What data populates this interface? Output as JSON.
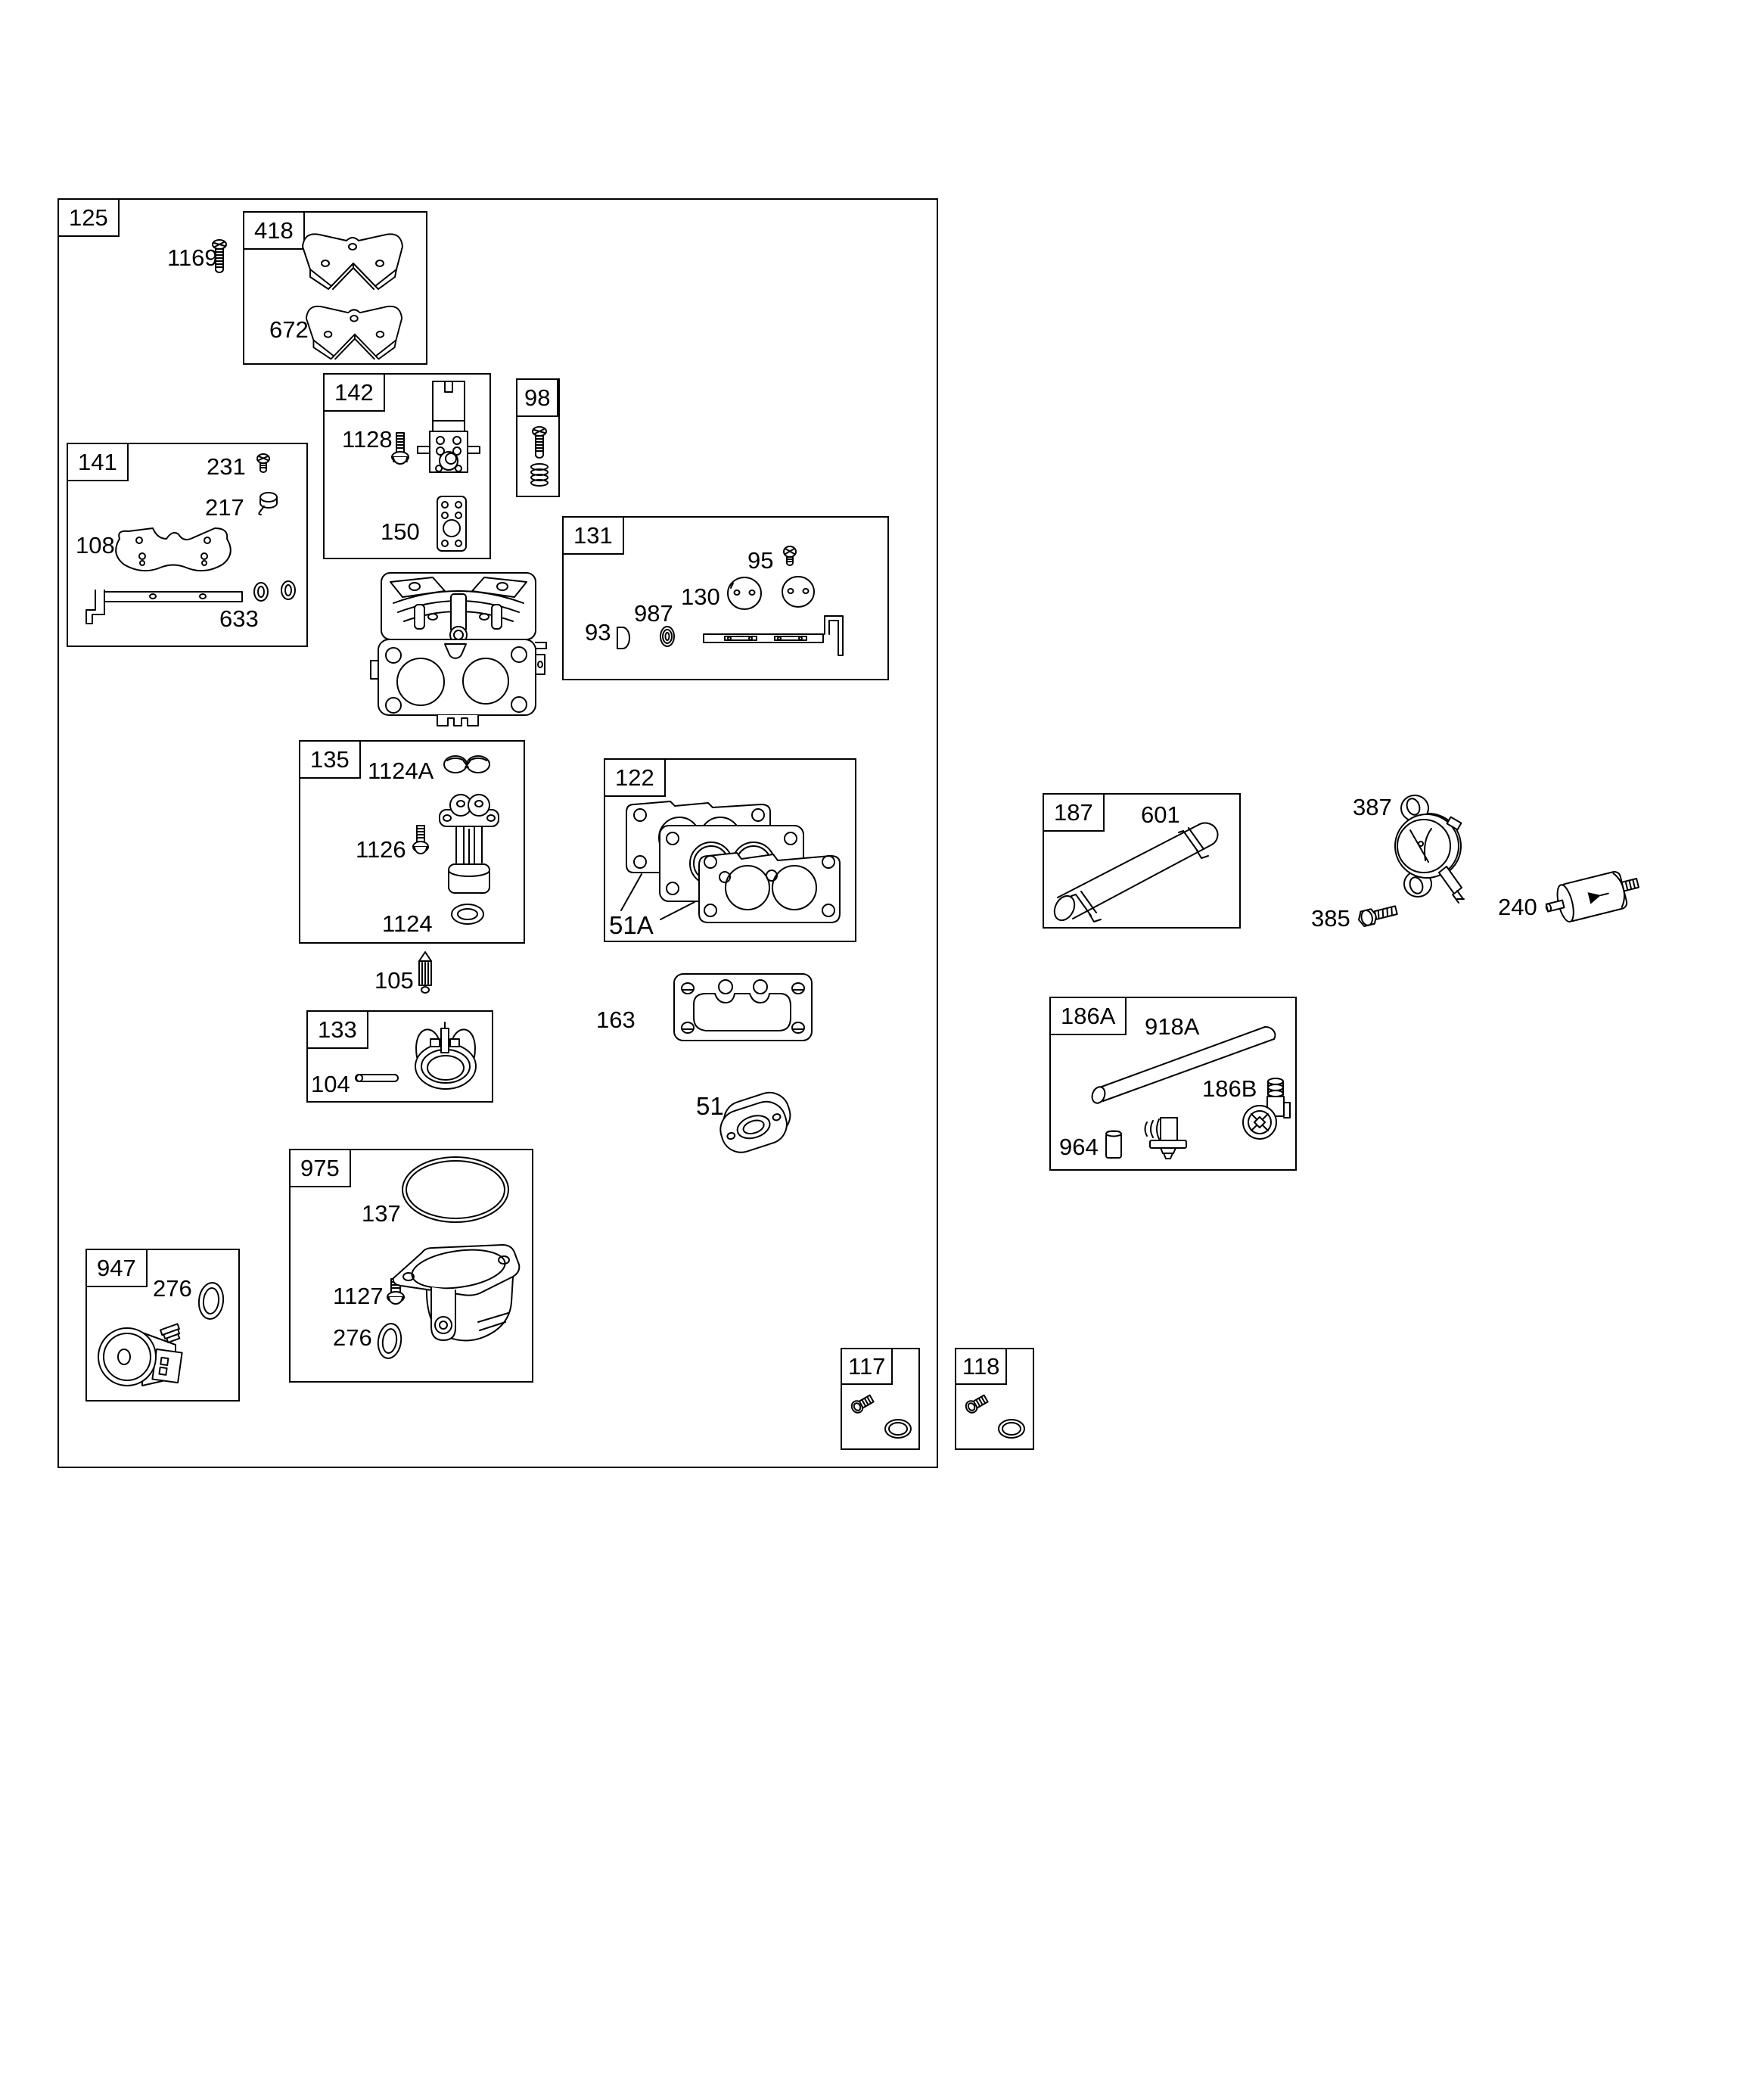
{
  "diagram_type": "exploded-parts-diagram",
  "colors": {
    "background": "#ffffff",
    "line": "#000000",
    "text": "#000000"
  },
  "assemblies": {
    "a125": {
      "ref": "125",
      "parts": {
        "p1169": "1169"
      }
    },
    "a418": {
      "ref": "418",
      "parts": {
        "p672": "672"
      }
    },
    "a142": {
      "ref": "142",
      "parts": {
        "p1128": "1128",
        "p150": "150"
      }
    },
    "a98": {
      "ref": "98"
    },
    "a141": {
      "ref": "141",
      "parts": {
        "p231": "231",
        "p217": "217",
        "p108": "108",
        "p633": "633"
      }
    },
    "a131": {
      "ref": "131",
      "parts": {
        "p95": "95",
        "p130": "130",
        "p987": "987",
        "p93": "93"
      }
    },
    "a135": {
      "ref": "135",
      "parts": {
        "p1124A": "1124A",
        "p1126": "1126",
        "p1124": "1124"
      }
    },
    "a122": {
      "ref": "122",
      "parts": {
        "p51A": "51A"
      }
    },
    "a133": {
      "ref": "133",
      "parts": {
        "p104": "104"
      }
    },
    "a975": {
      "ref": "975",
      "parts": {
        "p137": "137",
        "p1127": "1127",
        "p276": "276"
      }
    },
    "a947": {
      "ref": "947",
      "parts": {
        "p276": "276"
      }
    },
    "a117": {
      "ref": "117"
    },
    "a118": {
      "ref": "118"
    },
    "a187": {
      "ref": "187",
      "parts": {
        "p601": "601"
      }
    },
    "a186A": {
      "ref": "186A",
      "parts": {
        "p918A": "918A",
        "p186B": "186B",
        "p964": "964"
      }
    }
  },
  "loose_parts": {
    "p105": "105",
    "p163": "163",
    "p51": "51",
    "p387": "387",
    "p385": "385",
    "p240": "240"
  },
  "icons": {
    "screw-icon": "line-art",
    "spring-icon": "line-art",
    "o-ring-icon": "line-art",
    "washer-icon": "line-art",
    "gasket-icon": "line-art",
    "air-cleaner-plate-icon": "line-art",
    "solenoid-bracket-icon": "line-art",
    "throttle-disc-icon": "line-art",
    "throttle-shaft-icon": "line-art",
    "float-icon": "line-art",
    "nozzle-icon": "line-art",
    "needle-valve-icon": "line-art",
    "pin-icon": "line-art",
    "fuel-bowl-icon": "line-art",
    "fuel-solenoid-icon": "line-art",
    "bolt-icon": "line-art",
    "fuel-hose-icon": "line-art",
    "fuel-pump-icon": "line-art",
    "fuel-filter-icon": "line-art",
    "fuel-tube-icon": "line-art",
    "elbow-fitting-icon": "line-art",
    "sleeve-icon": "line-art",
    "clip-icon": "line-art",
    "plug-icon": "line-art",
    "spacer-icon": "line-art",
    "carburetor-body-icon": "line-art",
    "gasket-stack-icon": "line-art",
    "bracket-rod-icon": "line-art"
  }
}
